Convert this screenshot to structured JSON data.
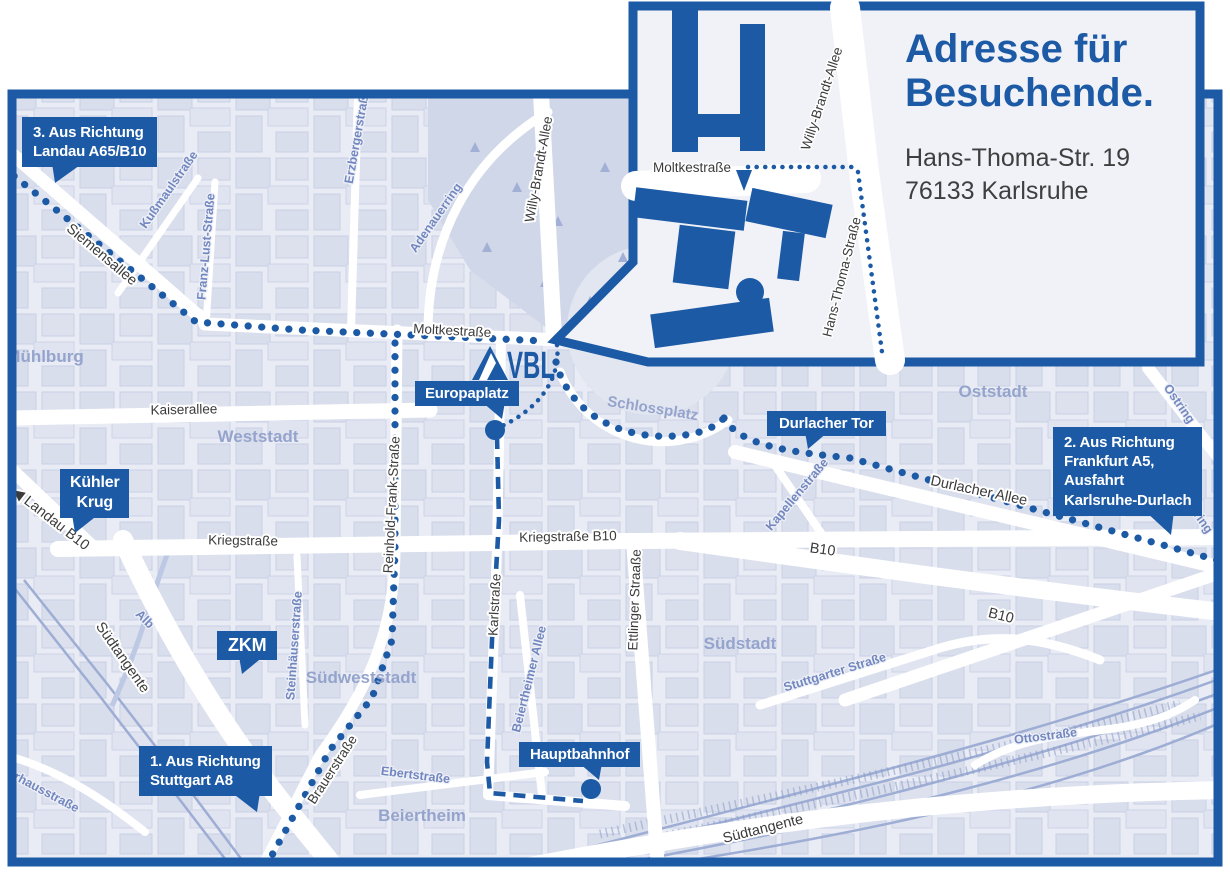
{
  "inset": {
    "title": {
      "line1": "Adresse für",
      "line2": "Besuchende."
    },
    "address": {
      "line1": "Hans-Thoma-Str. 19",
      "line2": "76133 Karlsruhe"
    },
    "labels": {
      "moltkestrasse": "Moltkestraße",
      "willy_brandt_allee": "Willy-Brandt-Allee",
      "hans_thoma_strasse": "Hans-Thoma-Straße"
    }
  },
  "logo": {
    "text": "VBL"
  },
  "callouts": {
    "landau": {
      "line1": "3. Aus Richtung",
      "line2": "Landau A65/B10"
    },
    "frankfurt": {
      "line1": "2. Aus Richtung",
      "line2": "Frankfurt A5,",
      "line3": "Ausfahrt",
      "line4": "Karlsruhe-Durlach"
    },
    "stuttgart": {
      "line1": "1. Aus Richtung",
      "line2": "Stuttgart A8"
    },
    "kuehler_krug": {
      "line1": "Kühler",
      "line2": "Krug"
    },
    "zkm": {
      "label": "ZKM"
    },
    "europaplatz": {
      "label": "Europaplatz"
    },
    "durlacher_tor": {
      "label": "Durlacher Tor"
    },
    "hauptbahnhof": {
      "label": "Hauptbahnhof"
    }
  },
  "districts": {
    "muehlburg": "Mühlburg",
    "weststadt": "Weststadt",
    "oststadt": "Oststadt",
    "schlossplatz": "Schlossplatz",
    "suedweststadt": "Südweststadt",
    "suedstadt": "Südstadt",
    "beiertheim": "Beiertheim"
  },
  "streets": {
    "siemensallee": "Siemensallee",
    "moltkestrasse": "Moltkestraße",
    "kaiserallee": "Kaiserallee",
    "kriegstrasse": "Kriegstraße",
    "kriegstrasse_b10": "Kriegstraße B10",
    "reinhold_frank_strasse": "Reinhold-Frank-Straße",
    "karlstrasse": "Karlstraße",
    "ettlinger_strasse": "Ettlinger Straaße",
    "willy_brandt_allee": "Willy-Brandt-Allee",
    "durlacher_allee": "Durlacher Allee",
    "b10_mid": "B10",
    "b10_south": "B10",
    "landau_b10": "◀ Landau B10",
    "suedtangente_west": "Südtangente",
    "suedtangente_sued": "Südtangente",
    "brauerstrasse": "Brauerstraße",
    "kussmaulstrasse": "Kußmaulstraße",
    "franz_lust_strasse": "Franz-Lust-Straße",
    "erzbergerstrasse": "Erzbergerstraße",
    "adenauerring": "Adenauerring",
    "kapellenstrasse": "Kapellenstraße",
    "ostring_nord": "Ostring",
    "ostring_sued": "Ostring",
    "steinhaeuserstrasse": "Steinhäuserstraße",
    "alb": "Alb",
    "ebertstrasse": "Ebertstraße",
    "beiertheimer_allee": "Beiertheimer Allee",
    "stuttgarter_strasse": "Stuttgarter Straße",
    "ottostrasse": "Ottostraße",
    "pulverhausstrasse": "Pulverhausstraße"
  },
  "colors": {
    "brand_blue": "#1c5aa5",
    "map_background": "#e9ecf4",
    "building_block": "#d3d9e9",
    "park": "#d0d7e9",
    "street_white": "#ffffff",
    "district_label": "#95a4cc",
    "street_label_dark": "#3b3b3b",
    "street_label_blue": "#7287bf",
    "route_blue": "#1c5aa5"
  }
}
